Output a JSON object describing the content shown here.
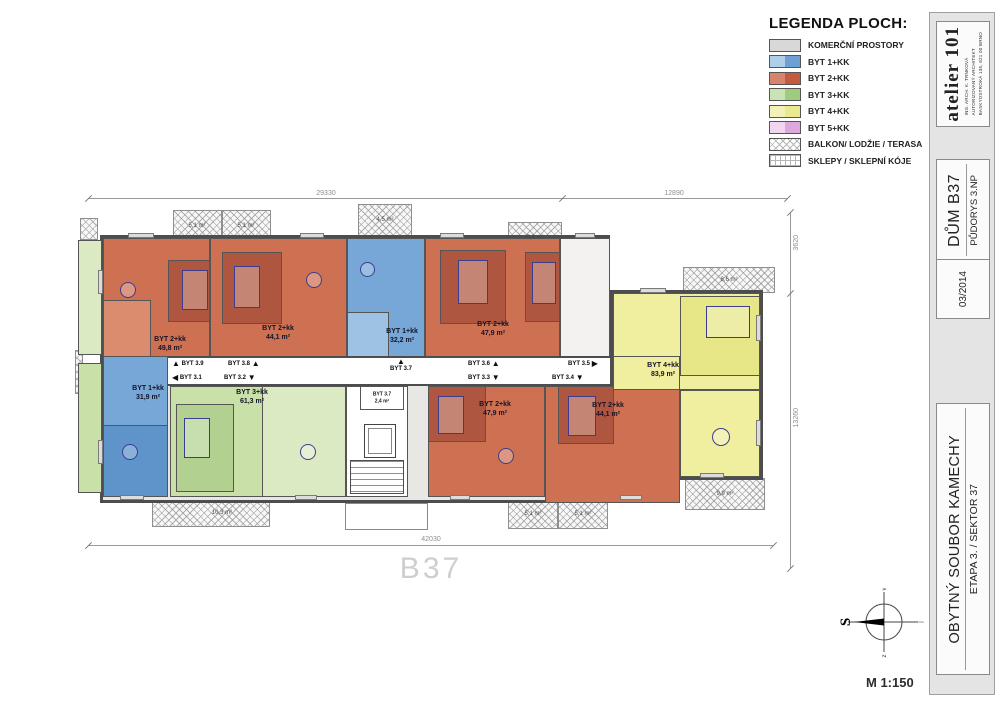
{
  "legend": {
    "title": "LEGENDA PLOCH:",
    "items": [
      {
        "label": "KOMERČNÍ PROSTORY",
        "type": "komercni"
      },
      {
        "label": "BYT 1+KK",
        "type": "byt1"
      },
      {
        "label": "BYT 2+KK",
        "type": "byt2"
      },
      {
        "label": "BYT 3+KK",
        "type": "byt3"
      },
      {
        "label": "BYT 4+KK",
        "type": "byt4"
      },
      {
        "label": "BYT 5+KK",
        "type": "byt5"
      },
      {
        "label": "BALKON/ LODŽIE / TERASA",
        "type": "balkon"
      },
      {
        "label": "SKLEPY / SKLEPNÍ KÓJE",
        "type": "sklepy"
      }
    ]
  },
  "titleblock": {
    "studio": {
      "name": "atelier 101",
      "line1": "ING. ARCH. K. TRNKOVÁ",
      "line2": "AUTORIZOVANÝ ARCHITEKT",
      "line3": "BASKYDSTROKÁ 135, 621 00 BRNO"
    },
    "building": {
      "title": "DŮM B37",
      "subtitle": "PŮDORYS 3.NP"
    },
    "date": "03/2014",
    "project": {
      "title": "OBYTNÝ SOUBOR KAMECHY",
      "subtitle": "ETAPA 3. / SEKTOR 37"
    },
    "scale": "M 1:150"
  },
  "compass": {
    "n": "S",
    "top": "v",
    "right": "j",
    "bottom": "z"
  },
  "plan": {
    "building_label": "B37",
    "dimensions": {
      "top_left": "29330",
      "top_right": "12890",
      "right_top": "3620",
      "right_bottom": "13260",
      "bottom": "42030"
    },
    "apartments": [
      {
        "unit": "BYT 3.9",
        "type": "BYT 2+kk",
        "area": "49,8 m²"
      },
      {
        "unit": "BYT 3.8",
        "type": "BYT 2+kk",
        "area": "44,1 m²"
      },
      {
        "unit": "BYT 3.7",
        "type": "BYT 1+kk",
        "area": "32,2 m²"
      },
      {
        "unit": "BYT 3.6",
        "type": "BYT 2+kk",
        "area": "47,9 m²"
      },
      {
        "unit": "BYT 3.5",
        "type": "BYT 4+kk",
        "area": "83,9 m²"
      },
      {
        "unit": "BYT 3.1",
        "type": "BYT 1+kk",
        "area": "31,9 m²"
      },
      {
        "unit": "BYT 3.2",
        "type": "BYT 3+kk",
        "area": "61,3 m²"
      },
      {
        "unit": "BYT 3.3",
        "type": "BYT 2+kk",
        "area": "47,9 m²"
      },
      {
        "unit": "BYT 3.4",
        "type": "BYT 2+kk",
        "area": "44,1 m²"
      }
    ],
    "sklep": {
      "unit": "BYT 3.7",
      "area": "2,4 m²"
    },
    "balconies": [
      "5,1 m²",
      "5,1 m²",
      "4,5 m²",
      "5,6 m²",
      "8,6 m²",
      "9,9 m²",
      "5,1 m²",
      "5,1 m²",
      "10,3 m²"
    ],
    "corridor": [
      {
        "label": "BYT 3.9",
        "arrow": "▲"
      },
      {
        "label": "BYT 3.1",
        "arrow": "◀"
      },
      {
        "label": "BYT 3.8",
        "arrow": "▲"
      },
      {
        "label": "BYT 3.2",
        "arrow": "▼"
      },
      {
        "label": "BYT 3.7",
        "arrow": "▲"
      },
      {
        "label": "BYT 3.6",
        "arrow": "▲"
      },
      {
        "label": "BYT 3.3",
        "arrow": "▼"
      },
      {
        "label": "BYT 3.5",
        "arrow": "▶"
      },
      {
        "label": "BYT 3.4",
        "arrow": "▼"
      }
    ]
  }
}
